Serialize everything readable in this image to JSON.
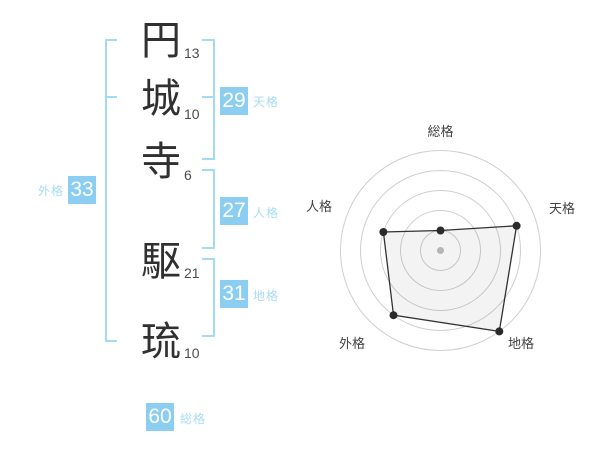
{
  "name_panel": {
    "surname": [
      {
        "char": "円",
        "strokes": "13"
      },
      {
        "char": "城",
        "strokes": "10"
      },
      {
        "char": "寺",
        "strokes": "6"
      }
    ],
    "given": [
      {
        "char": "駆",
        "strokes": "21"
      },
      {
        "char": "琉",
        "strokes": "10"
      }
    ],
    "kaku": {
      "tenkaku": {
        "label": "天格",
        "value": "29"
      },
      "jinkaku": {
        "label": "人格",
        "value": "27"
      },
      "chikaku": {
        "label": "地格",
        "value": "31"
      },
      "gaikaku": {
        "label": "外格",
        "value": "33"
      },
      "soukaku": {
        "label": "総格",
        "value": "60"
      }
    }
  },
  "colors": {
    "badge_blue": "#8BCEF1",
    "label_blue": "#A7DCF6",
    "bracket_blue": "#A3DAF4",
    "kanji_dark": "#303030",
    "stroke_gray": "#4D4D4D",
    "ring_gray": "#CFCFCF",
    "chart_line": "#333333",
    "chart_dot": "#2B2B2B",
    "chart_center_dot": "#B5B5B5",
    "chart_label": "#444444",
    "chart_fill": "rgba(80,80,80,0.07)"
  },
  "chart_data": {
    "type": "radar",
    "axes": [
      "総格",
      "天格",
      "地格",
      "外格",
      "人格"
    ],
    "values": [
      20,
      80,
      100,
      80,
      60
    ],
    "max": 100,
    "rings": 5,
    "angles_deg": [
      90,
      18,
      -54,
      -126,
      162
    ],
    "grid": "concentric-circles",
    "legend": "none"
  }
}
